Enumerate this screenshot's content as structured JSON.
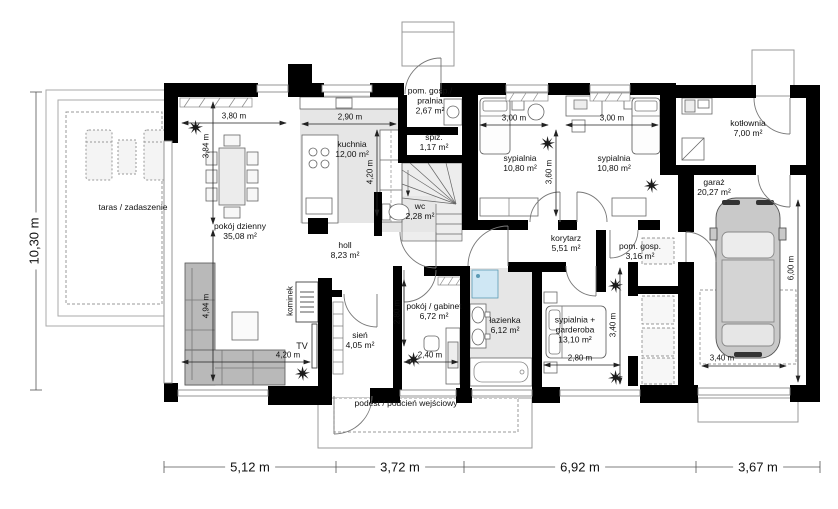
{
  "rooms": {
    "taras": {
      "label": "taras / zadaszenie",
      "area": ""
    },
    "pokoj_dzienny": {
      "label": "pokój dzienny",
      "area": "35,08 m²"
    },
    "kuchnia": {
      "label": "kuchnia",
      "area": "12,00 m²"
    },
    "pralnia": {
      "label": "pom. gosp./ pralnia",
      "area": "2,67 m²"
    },
    "spiz": {
      "label": "spiż.",
      "area": "1,17 m²"
    },
    "wc": {
      "label": "wc",
      "area": "2,28 m²"
    },
    "holl": {
      "label": "holl",
      "area": "8,23 m²"
    },
    "sien": {
      "label": "sień",
      "area": "4,05 m²"
    },
    "gabinet": {
      "label": "pokój / gabinet",
      "area": "6,72 m²"
    },
    "lazienka": {
      "label": "łazienka",
      "area": "6,12 m²"
    },
    "sypialnia_garderoba": {
      "label": "sypialnia + garderoba",
      "area": "13,10 m²"
    },
    "korytarz": {
      "label": "korytarz",
      "area": "5,51 m²"
    },
    "pom_gosp": {
      "label": "pom. gosp.",
      "area": "3,16 m²"
    },
    "sypialnia_1": {
      "label": "sypialnia",
      "area": "10,80 m²"
    },
    "sypialnia_2": {
      "label": "sypialnia",
      "area": "10,80 m²"
    },
    "kotlownia": {
      "label": "kotłownia",
      "area": "7,00 m²"
    },
    "garaz": {
      "label": "garaż",
      "area": "20,27 m²"
    },
    "podest": {
      "label": "podest / podcień wejściowy",
      "area": ""
    }
  },
  "annotations": {
    "kominek": "kominek",
    "tv": "TV"
  },
  "dims": {
    "total_height": "10,30 m",
    "bottom": [
      "5,12 m",
      "3,72 m",
      "6,92 m",
      "3,67 m"
    ],
    "living_w": "3,80 m",
    "living_h1": "3,84 m",
    "living_h2": "4,94 m",
    "tv_wall": "4,20 m",
    "kitchen_w": "2,90 m",
    "kitchen_h": "4,20 m",
    "bedroom1_w": "3,00 m",
    "bedroom2_w": "3,00 m",
    "bedrooms_h": "3,60 m",
    "gabinet_h": "2,80 m",
    "gabinet_w": "2,40 m",
    "bedroom3_w": "2,80 m",
    "bedroom3_h": "3,40 m",
    "garage_h": "6,00 m",
    "garage_w": "3,40 m"
  }
}
